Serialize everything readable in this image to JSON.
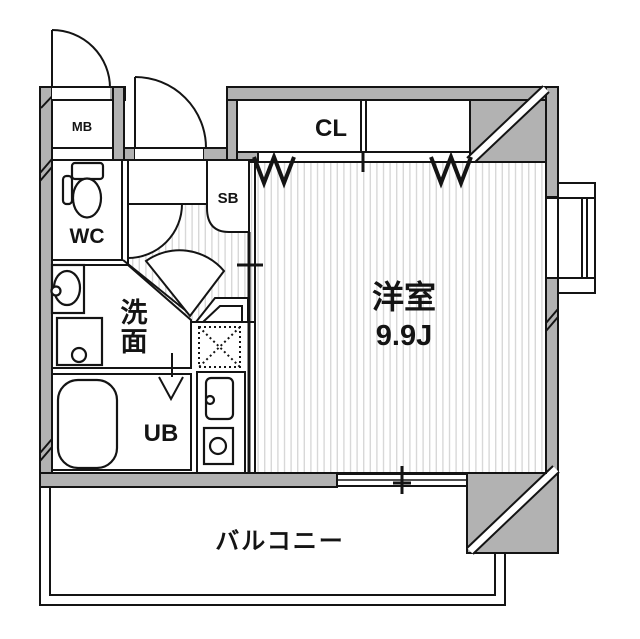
{
  "floorplan": {
    "rooms": {
      "meter_box": {
        "label": "MB"
      },
      "toilet": {
        "label": "WC"
      },
      "washroom": {
        "label": "洗面",
        "label_chars": [
          "洗",
          "面"
        ]
      },
      "unit_bath": {
        "label": "UB"
      },
      "shoe_box": {
        "label": "SB"
      },
      "closet": {
        "label": "CL"
      },
      "main_room": {
        "label": "洋室",
        "size": "9.9J"
      },
      "balcony": {
        "label": "バルコニー"
      }
    },
    "colors": {
      "wall": "#b2b2b2",
      "line": "#141414",
      "floor_stripe": "#d8d8d8",
      "background": "#ffffff"
    }
  }
}
